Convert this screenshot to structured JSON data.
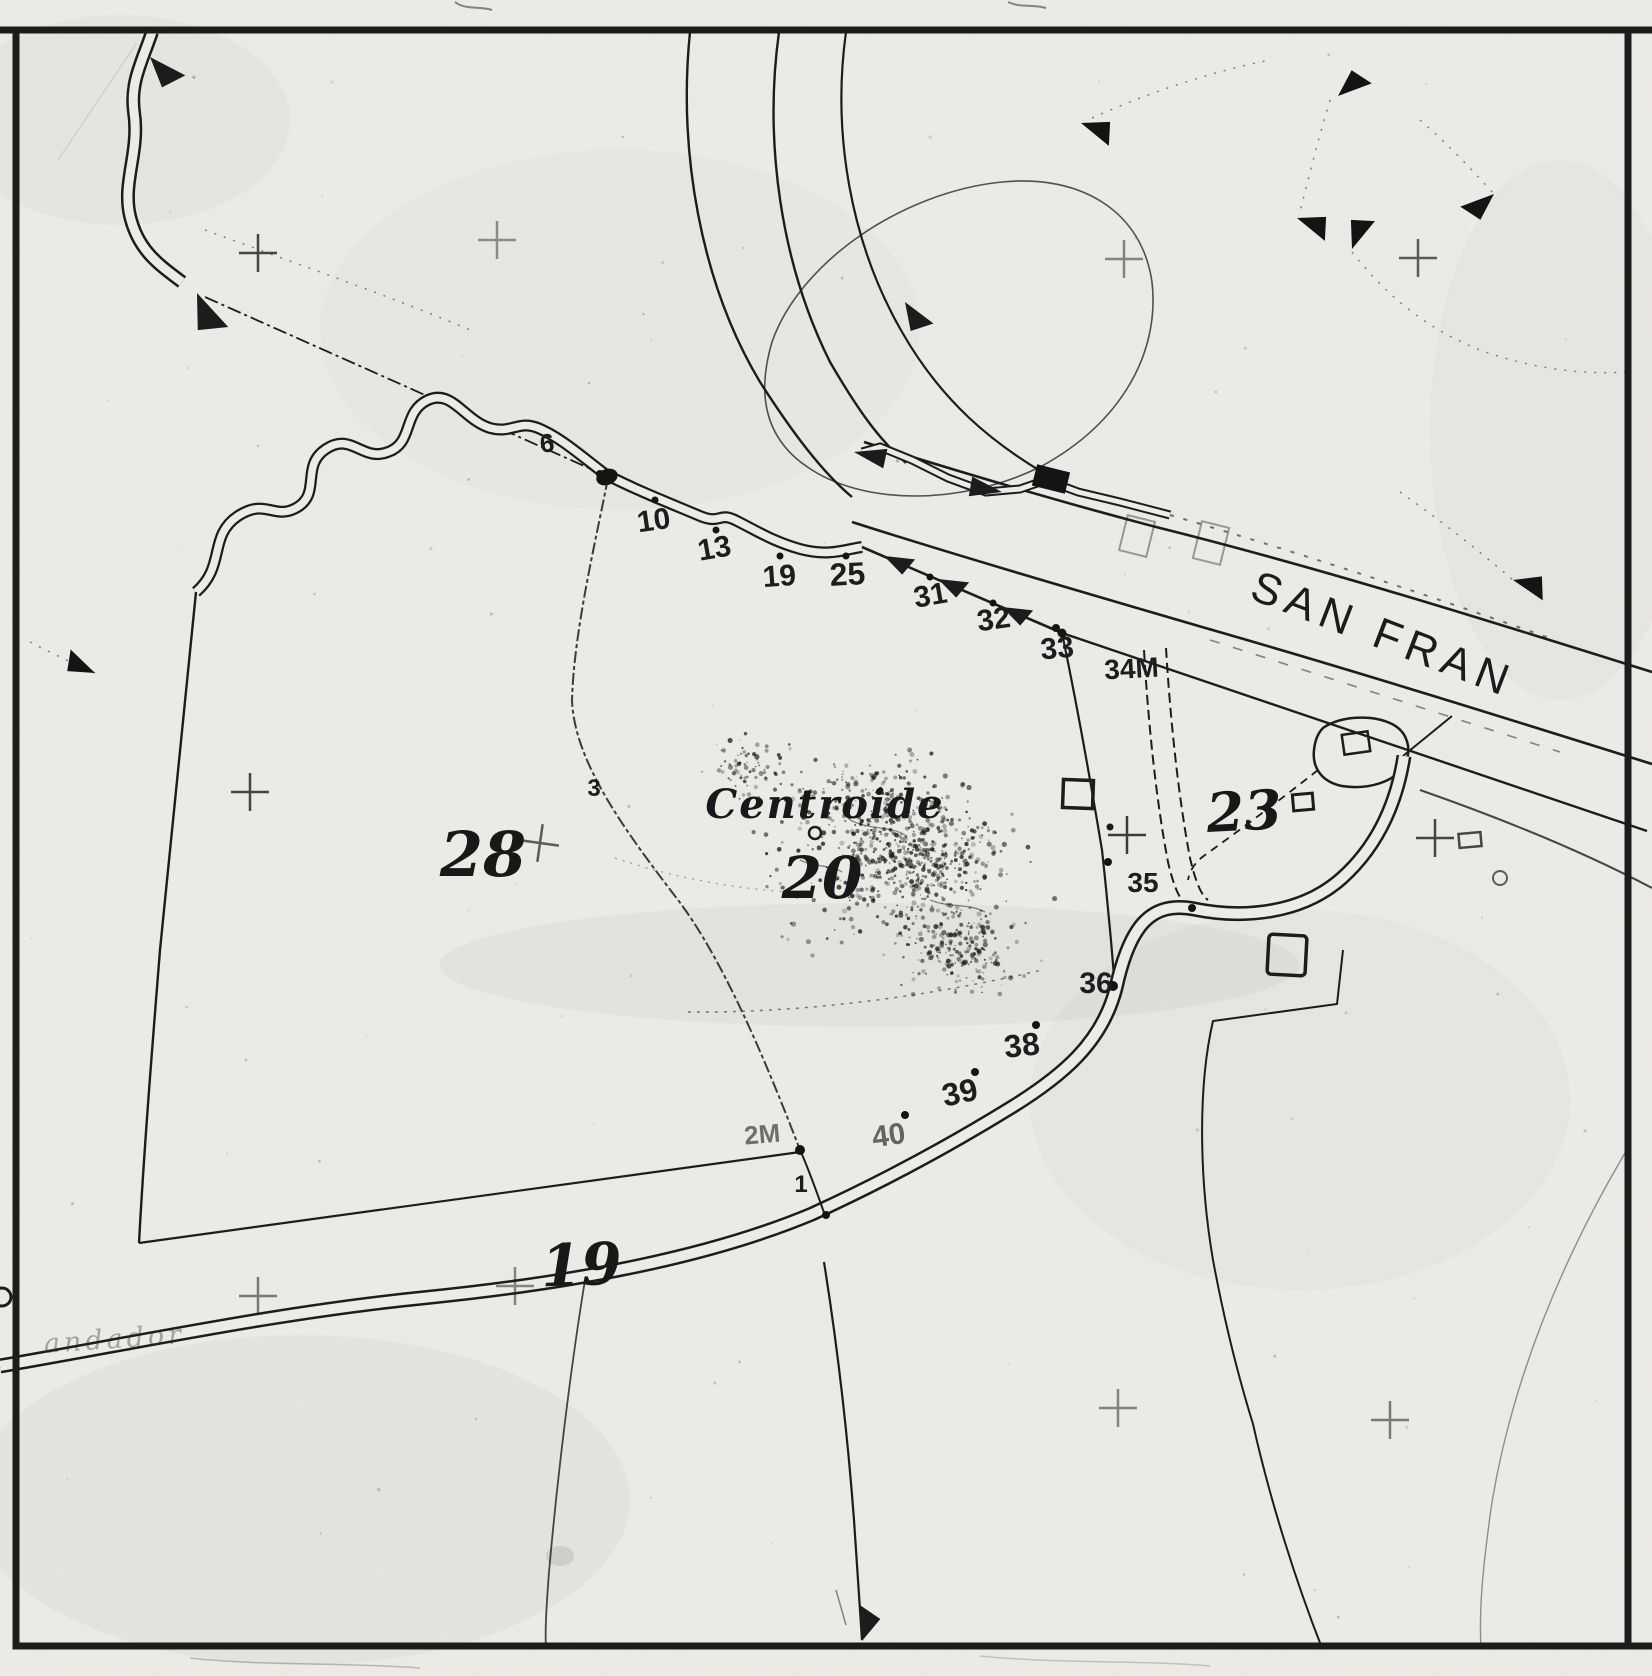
{
  "map": {
    "title_labels": {
      "road_name": "SAN FRAN",
      "centroide": "Centroide",
      "faded_road_text": "andador"
    },
    "parcels": {
      "p28": "28",
      "p20": "20",
      "p23": "23",
      "p19": "19"
    },
    "points": {
      "p6": "6",
      "p10": "10",
      "p13": "13",
      "p19": "19",
      "p25": "25",
      "p31": "31",
      "p32": "32",
      "p33": "33",
      "p34m": "34M",
      "p35": "35",
      "p36": "36",
      "p38": "38",
      "p39": "39",
      "p40": "40",
      "p2m": "2M",
      "p1": "1",
      "p3": "3"
    },
    "symbols": {
      "flow_arrow": "solid-triangle",
      "survey_cross": "plus",
      "centroide_marker": "small-circle",
      "building": "open-square"
    },
    "colors": {
      "ink": "#1c1c1c",
      "paper": "#edebe7",
      "faded": "#6b6b6b"
    }
  }
}
